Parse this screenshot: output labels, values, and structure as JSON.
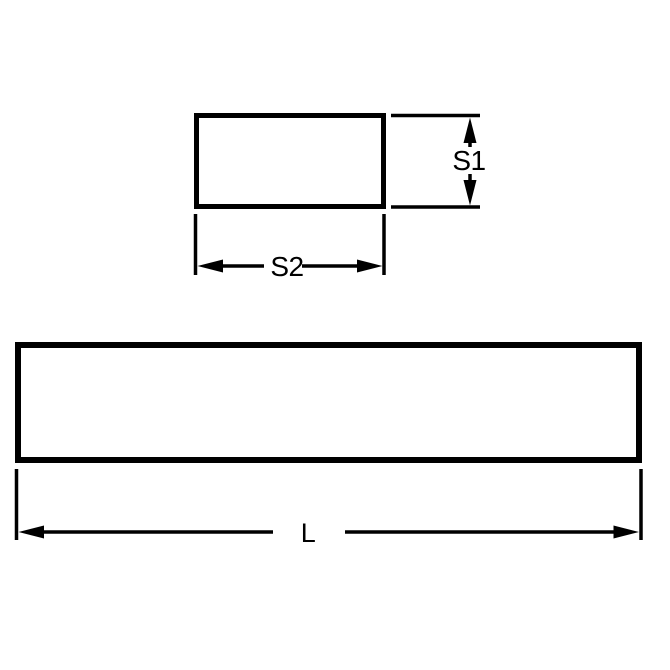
{
  "diagram": {
    "type": "technical-drawing",
    "background_color": "#ffffff",
    "stroke_color": "#000000",
    "views": [
      {
        "id": "cross-section",
        "dimension_labels": [
          "S1",
          "S2"
        ]
      },
      {
        "id": "side",
        "dimension_labels": [
          "L"
        ]
      }
    ],
    "labels": {
      "section_height": "S1",
      "section_width": "S2",
      "length": "L"
    }
  }
}
